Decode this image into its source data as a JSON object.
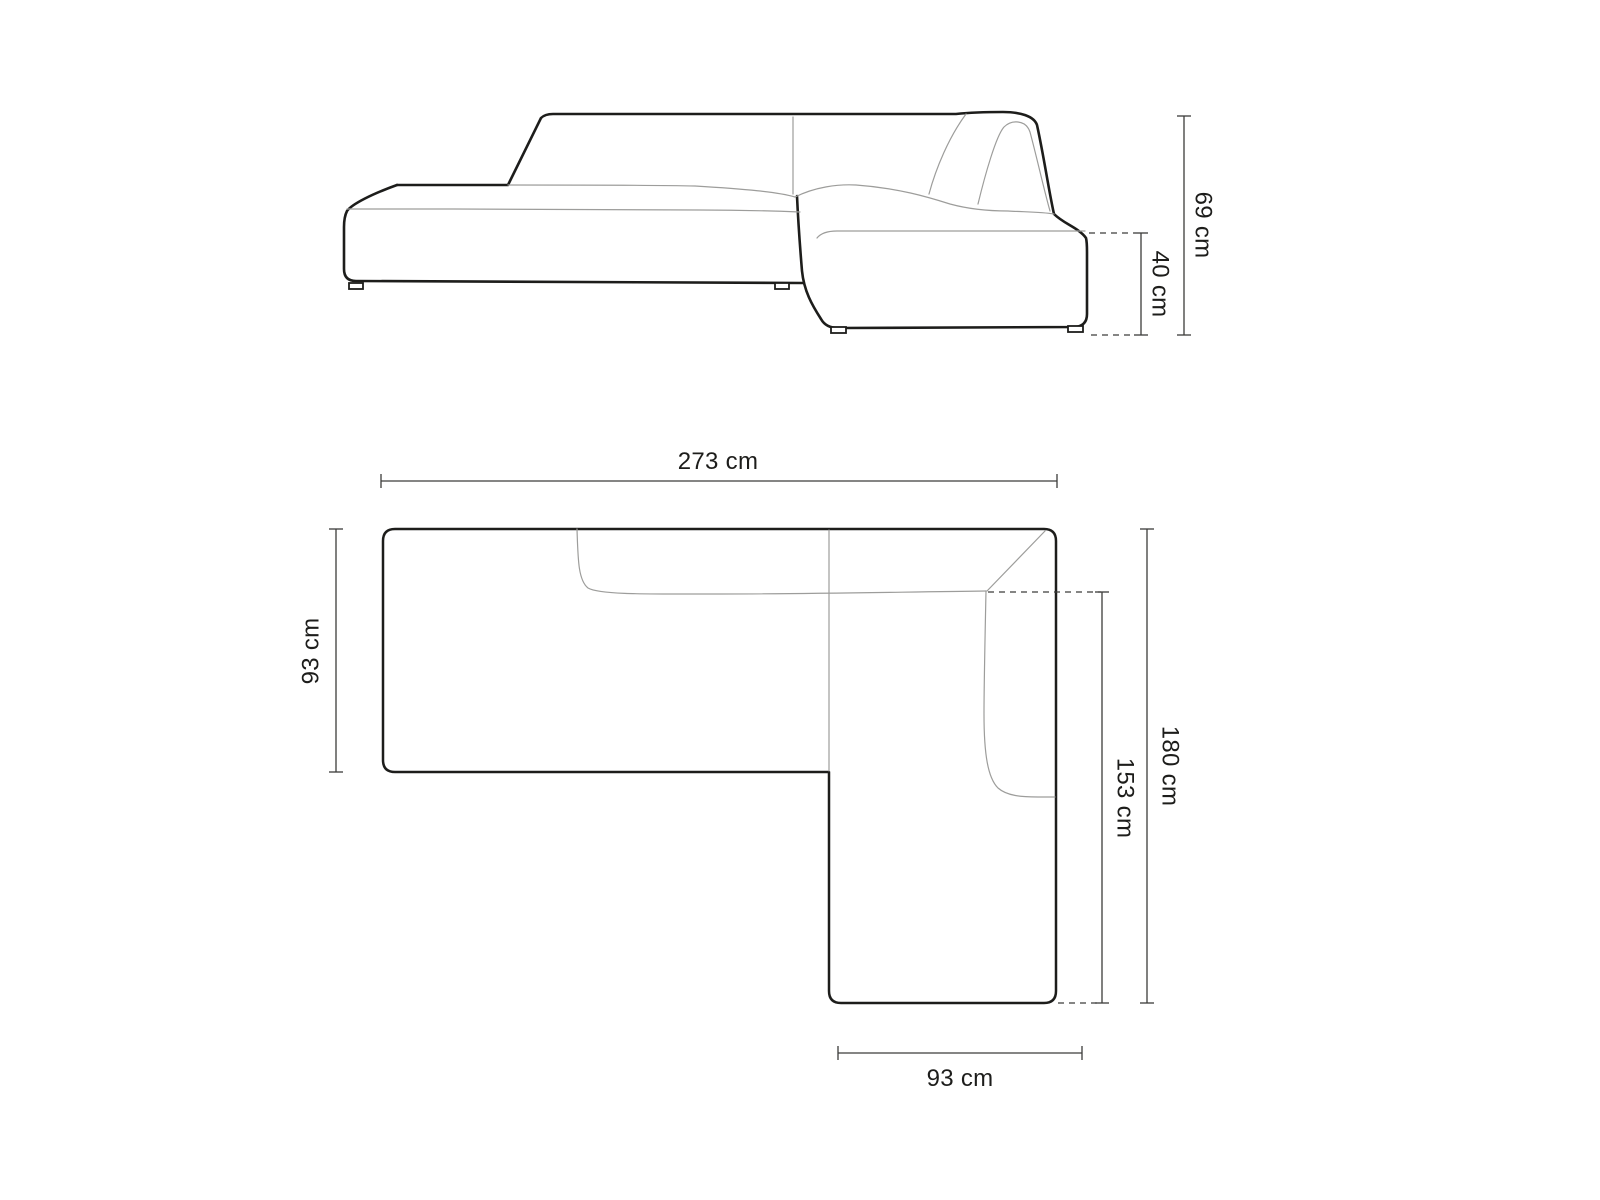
{
  "figure": {
    "type": "furniture-dimension-diagram",
    "subject": "right-corner modular sofa",
    "views": {
      "side_view_name": "side elevation",
      "top_view_name": "top plan"
    }
  },
  "side_view": {
    "total_height": "69 cm",
    "seat_height": "40 cm"
  },
  "top_view": {
    "total_width": "273 cm",
    "left_section_depth": "93 cm",
    "total_depth": "180 cm",
    "chaise_section_depth": "153 cm",
    "chaise_section_width": "93 cm"
  },
  "colors": {
    "background": "#ffffff",
    "outline": "#1d1d1b",
    "thin_line": "#9d9d9b",
    "dimension_line": "#3c3c3a",
    "label_text": "#1d1d1b"
  }
}
